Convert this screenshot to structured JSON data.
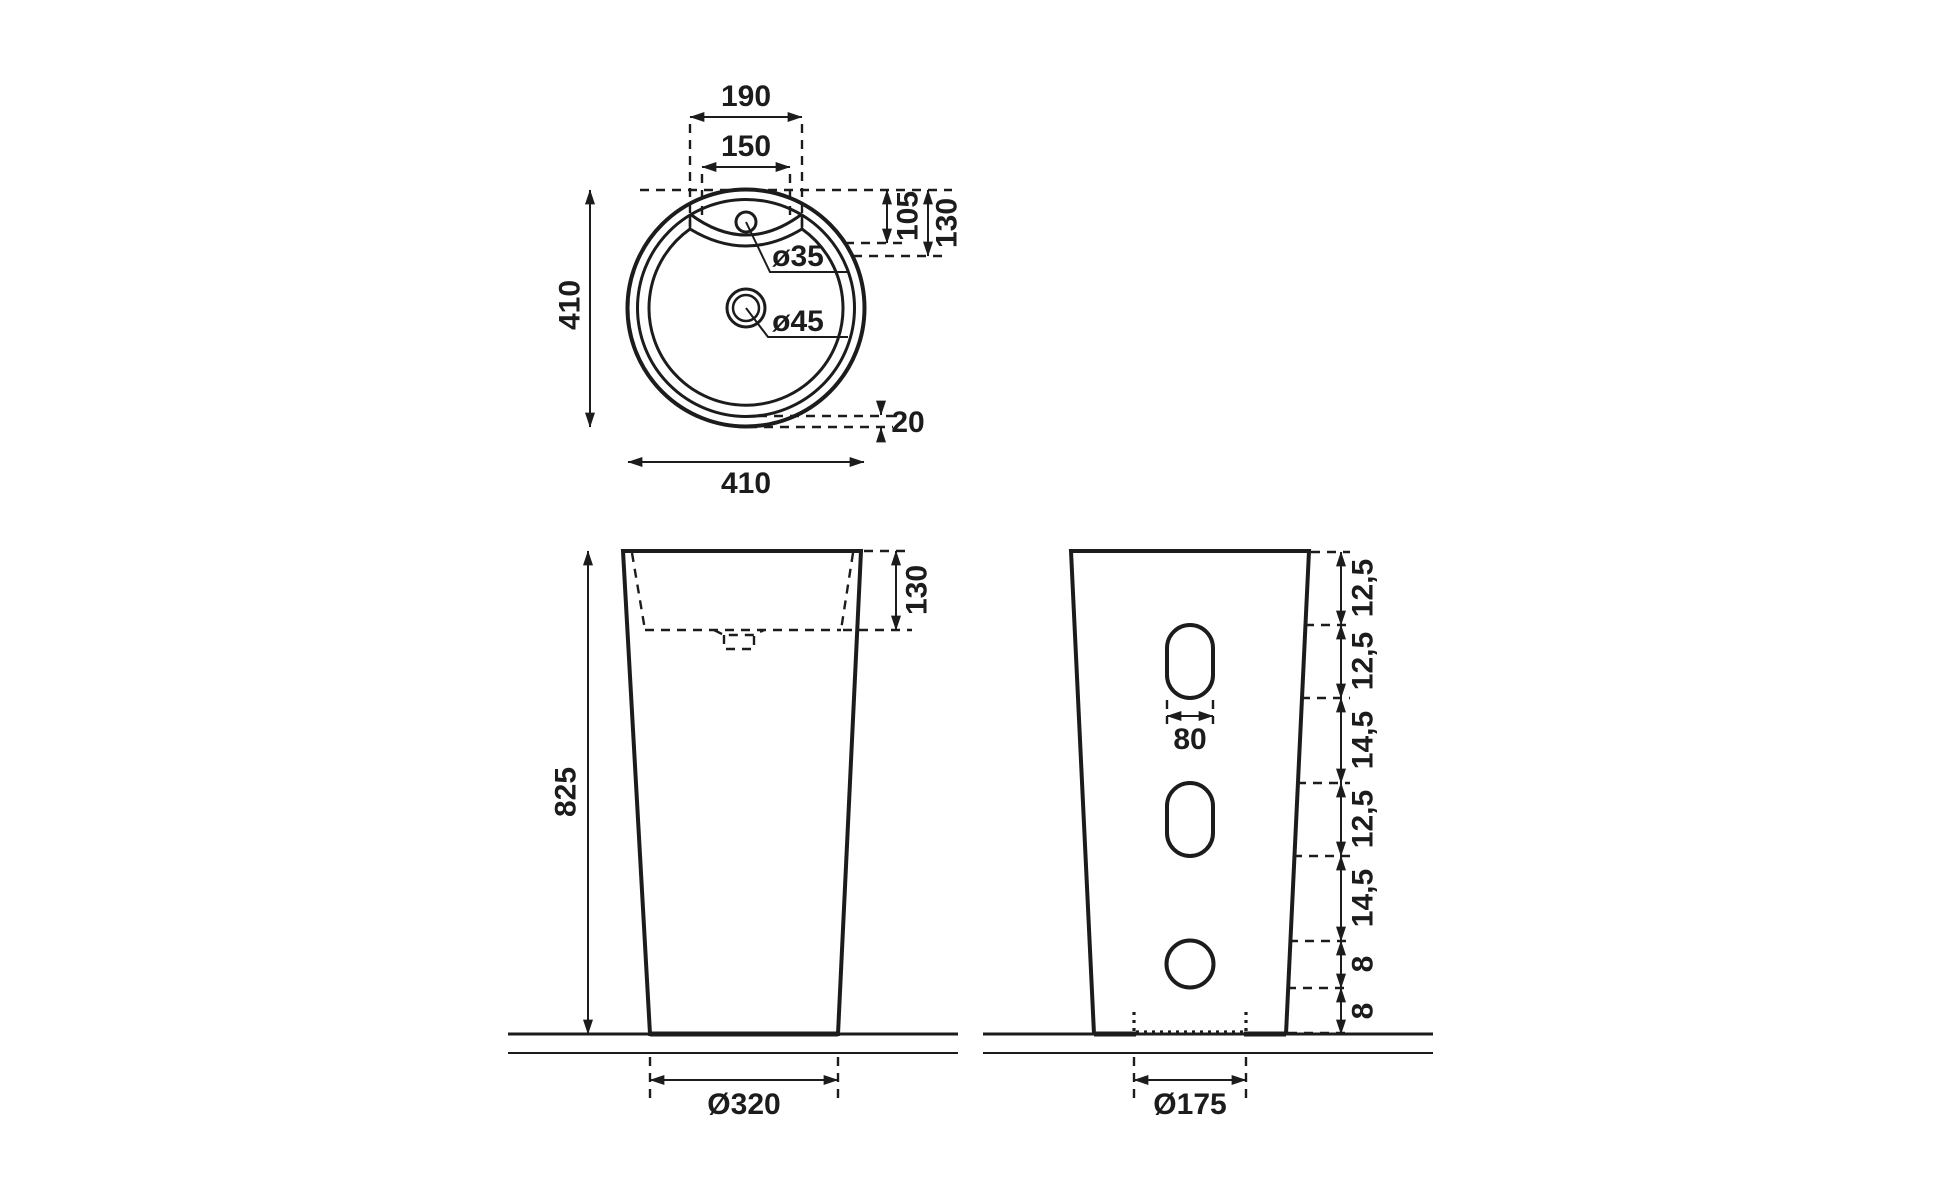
{
  "drawing": {
    "background": "#ffffff",
    "line_color": "#1c1c1c",
    "top_view": {
      "deck_width_outer": "190",
      "deck_width_inner": "150",
      "overall_depth": "410",
      "deck_depth_inner": "105",
      "deck_depth_outer": "130",
      "faucet_hole": "ø35",
      "drain_hole": "ø45",
      "rim_width": "20",
      "overall_width": "410"
    },
    "front_view": {
      "overall_height": "825",
      "basin_depth": "130",
      "base_diameter": "Ø320"
    },
    "side_view": {
      "height_segments": [
        "12,5",
        "12,5",
        "14,5",
        "12,5",
        "14,5",
        "8",
        "8"
      ],
      "hole_width": "80",
      "base_recess_diameter": "Ø175"
    }
  }
}
